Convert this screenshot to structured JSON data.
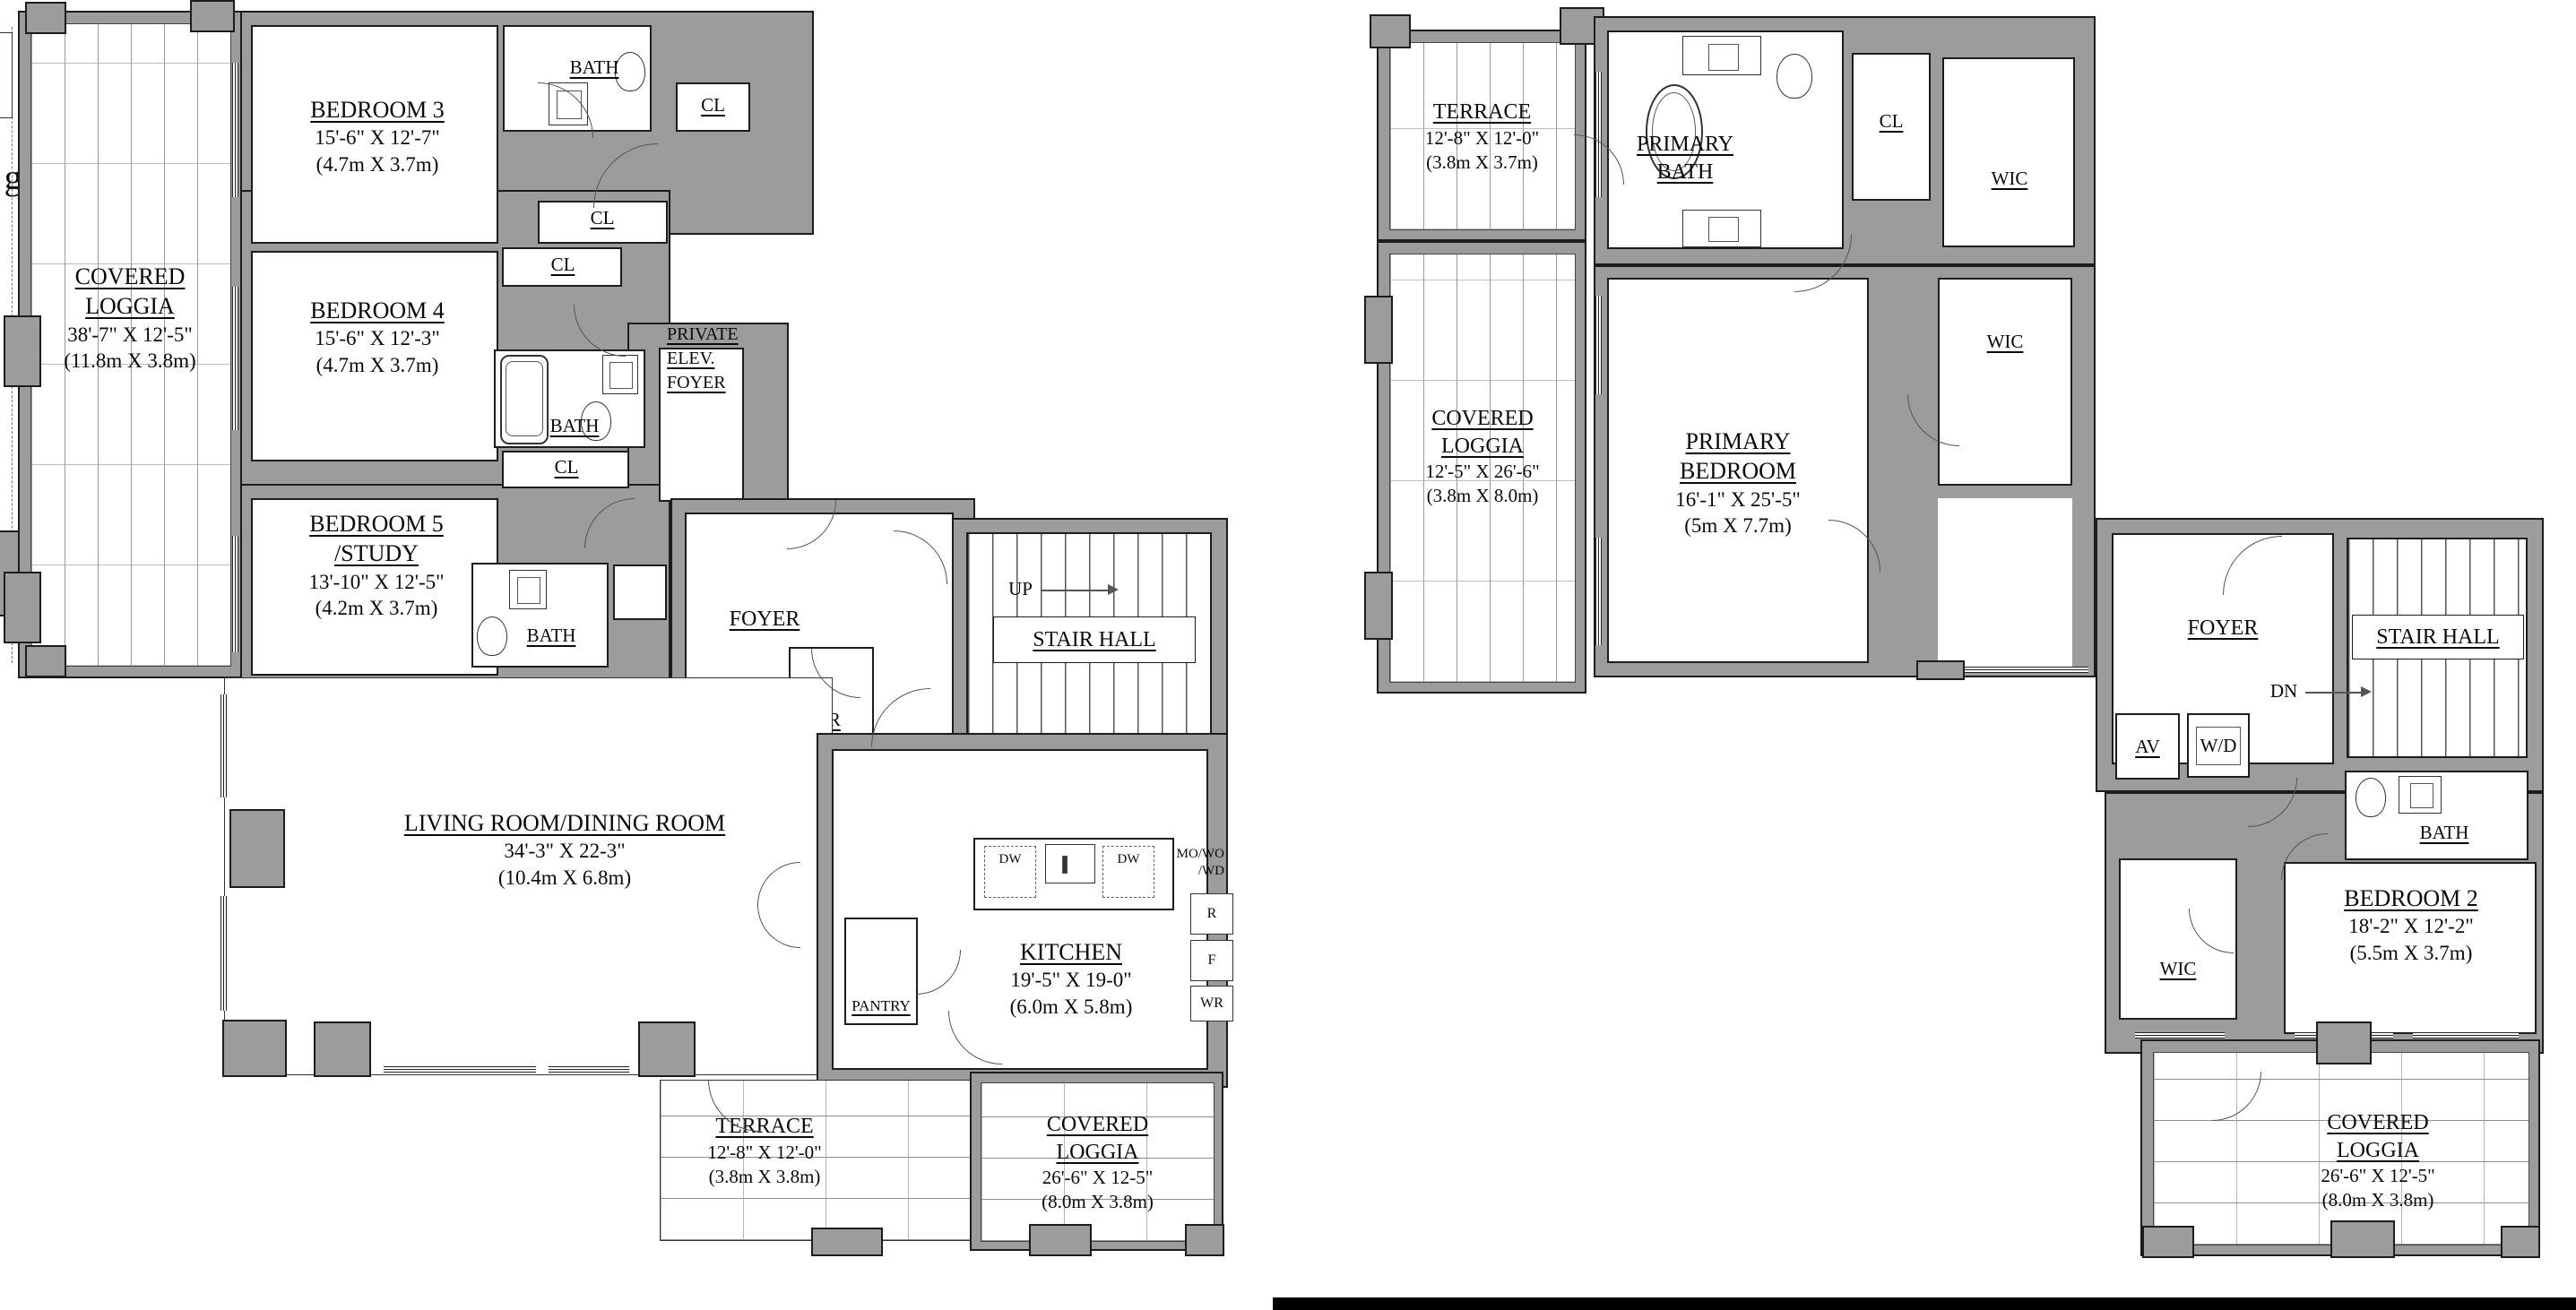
{
  "colors": {
    "wall": "#9c9c9c",
    "line": "#1c1c1c",
    "bar": "#000000"
  },
  "edge_fragment": "gia",
  "lower": {
    "loggia_w": {
      "name": "COVERED LOGGIA",
      "ft": "38'-7\" X 12'-5\"",
      "m": "(11.8m X 3.8m)"
    },
    "bedroom3": {
      "name": "BEDROOM 3",
      "ft": "15'-6\" X 12'-7\"",
      "m": "(4.7m X 3.7m)"
    },
    "bedroom4": {
      "name": "BEDROOM 4",
      "ft": "15'-6\" X 12'-3\"",
      "m": "(4.7m X 3.7m)"
    },
    "bedroom5": {
      "name": "BEDROOM 5 /STUDY",
      "ft": "13'-10\" X 12'-5\"",
      "m": "(4.2m X 3.7m)"
    },
    "living": {
      "name": "LIVING ROOM/DINING ROOM",
      "ft": "34'-3\" X 22-3\"",
      "m": "(10.4m X 6.8m)"
    },
    "kitchen": {
      "name": "KITCHEN",
      "ft": "19'-5\" X 19-0\"",
      "m": "(6.0m X 5.8m)"
    },
    "terrace": {
      "name": "TERRACE",
      "ft": "12'-8\" X 12'-0\"",
      "m": "(3.8m X 3.8m)"
    },
    "loggia_s": {
      "name": "COVERED LOGGIA",
      "ft": "26'-6\" X 12-5\"",
      "m": "(8.0m X 3.8m)"
    },
    "private_elev_foyer": "PRIVATE ELEV. FOYER",
    "foyer": "FOYER",
    "stair_hall": "STAIR HALL",
    "up": "UP",
    "pr": "PR",
    "pantry": "PANTRY"
  },
  "upper": {
    "terrace": {
      "name": "TERRACE",
      "ft": "12'-8\" X 12'-0\"",
      "m": "(3.8m X 3.7m)"
    },
    "primary_bath": "PRIMARY BATH",
    "loggia_w": {
      "name": "COVERED LOGGIA",
      "ft": "12'-5\" X 26'-6\"",
      "m": "(3.8m X 8.0m)"
    },
    "primary_bedroom": {
      "name": "PRIMARY BEDROOM",
      "ft": "16'-1\" X 25'-5\"",
      "m": "(5m X 7.7m)"
    },
    "bedroom2": {
      "name": "BEDROOM 2",
      "ft": "18'-2\" X 12'-2\"",
      "m": "(5.5m X 3.7m)"
    },
    "loggia_s": {
      "name": "COVERED LOGGIA",
      "ft": "26'-6\" X 12'-5\"",
      "m": "(8.0m X 3.8m)"
    },
    "foyer": "FOYER",
    "stair_hall": "STAIR HALL",
    "dn": "DN",
    "av": "AV",
    "wd": "W/D"
  },
  "labels": {
    "bath": "BATH",
    "cl": "CL",
    "wic": "WIC",
    "dw": "DW",
    "ct": "CT",
    "tg": "TG",
    "st_wo_wd": [
      "ST/WO/",
      "WD"
    ],
    "mo_wo_wd": [
      "MO/WO",
      "/WD"
    ],
    "r": "R",
    "f": "F",
    "wr": "WR"
  }
}
